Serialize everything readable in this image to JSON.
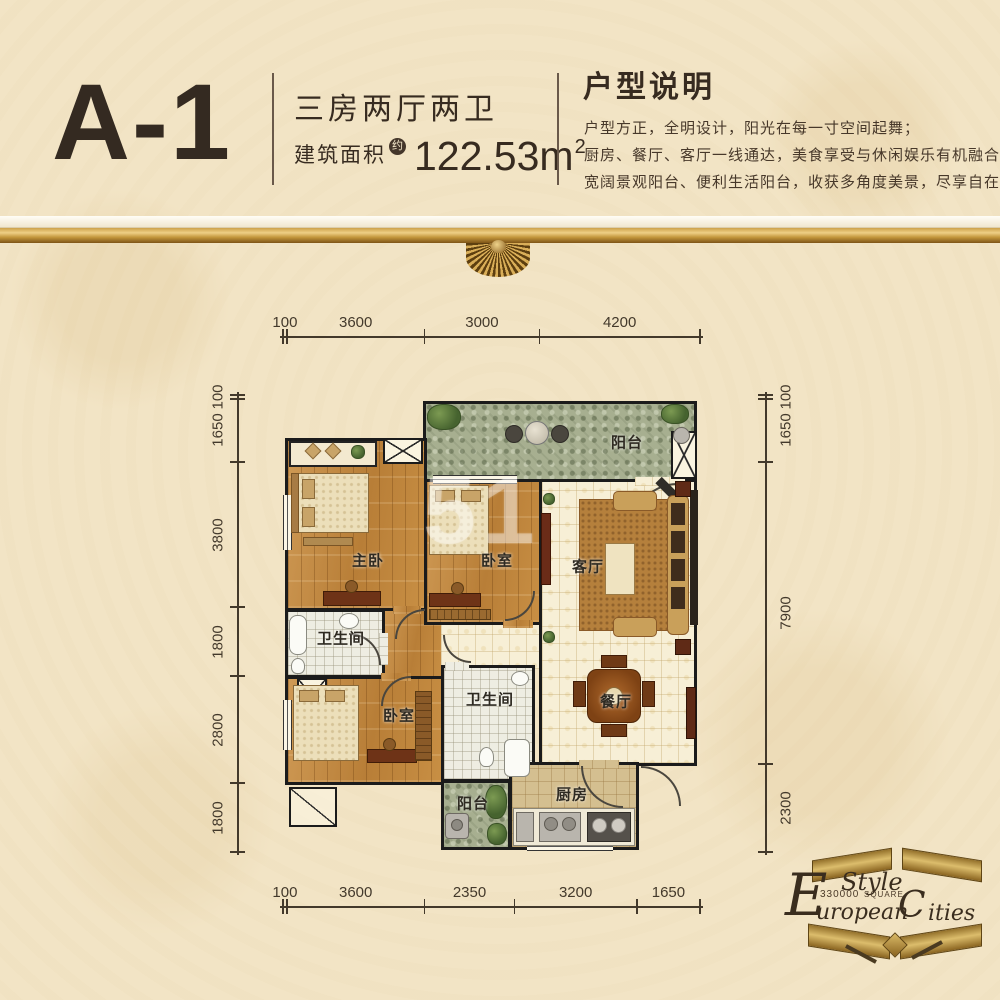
{
  "header": {
    "unit_code": "A-1",
    "unit_type": "三房两厅两卫",
    "area_label": "建筑面积",
    "area_approx": "约",
    "area_value": "122.53m",
    "area_exponent": "2",
    "desc_title": "户型说明",
    "desc_lines": [
      "户型方正，全明设计，阳光在每一寸空间起舞；",
      "厨房、餐厅、客厅一线通达，美食享受与休闲娱乐有机融合；",
      "宽阔景观阳台、便利生活阳台，收获多角度美景，尽享自在高贵人生。"
    ]
  },
  "dimensions_mm": {
    "top": [
      100,
      3600,
      3000,
      4200
    ],
    "bottom": [
      100,
      3600,
      2350,
      3200,
      1650
    ],
    "left": [
      100,
      1650,
      3800,
      1800,
      2800,
      1800
    ],
    "right": [
      100,
      1650,
      7900,
      2300
    ]
  },
  "rooms": {
    "balcony_top": "阳台",
    "master_bedroom": "主卧",
    "bedroom_top": "卧室",
    "living_room": "客厅",
    "bathroom_1": "卫生间",
    "bedroom_bottom": "卧室",
    "bathroom_2": "卫生间",
    "dining_room": "餐厅",
    "kitchen": "厨房",
    "balcony_bottom": "阳台"
  },
  "watermark": "51",
  "logo": {
    "style_word": "Style",
    "european_initial": "E",
    "european_rest": "uropean",
    "cities_initial": "C",
    "cities_rest": "ities",
    "number": "330000",
    "square_word": "SQUARE"
  },
  "colors": {
    "background": "#f2e4c5",
    "text_dark": "#372b20",
    "gold": "#c9983f",
    "wall": "#1b1b1b",
    "wood_floor": "#c3893d",
    "tile_cream": "#f7efd6",
    "balcony_green": "#a7af90",
    "kitchen_floor": "#d4bf90",
    "bath_tile": "#eeede2"
  }
}
